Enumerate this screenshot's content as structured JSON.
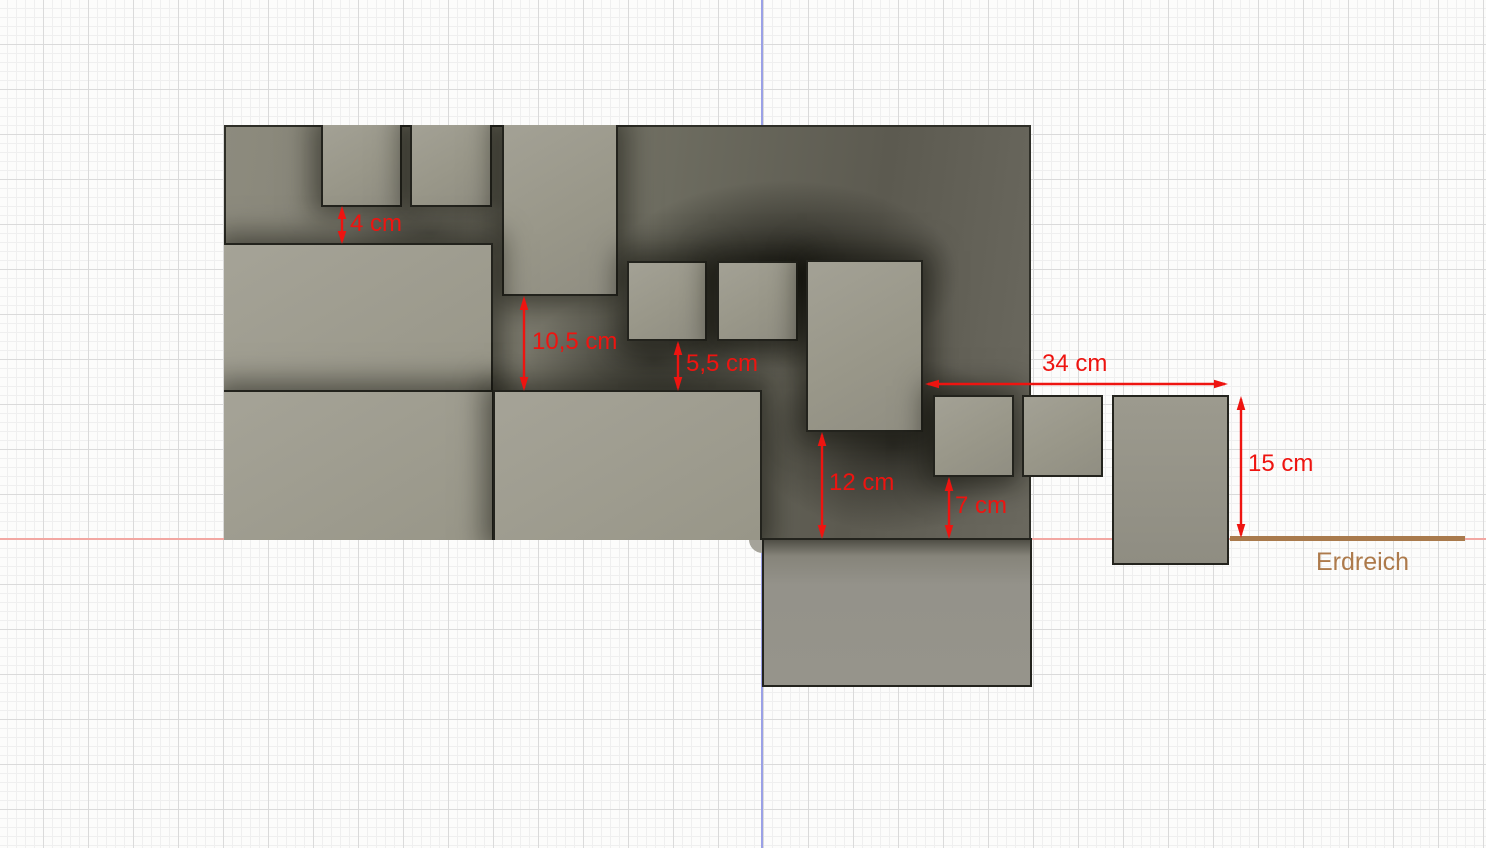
{
  "scene": {
    "dimensions": [
      {
        "id": "gap-top",
        "label": "4 cm"
      },
      {
        "id": "gap-mid-left",
        "label": "10,5 cm"
      },
      {
        "id": "gap-mid-center",
        "label": "5,5 cm"
      },
      {
        "id": "gap-low-center",
        "label": "12 cm"
      },
      {
        "id": "gap-low-right",
        "label": "7 cm"
      },
      {
        "id": "span-right",
        "label": "34 cm"
      },
      {
        "id": "depth-right",
        "label": "15 cm"
      }
    ],
    "ground_label": "Erdreich",
    "colors": {
      "dimension_red": "#ee1410",
      "ground_brown": "#a97a4c",
      "axis_horizontal_pink": "#f2a7a2",
      "axis_vertical_blue": "#9aa0e6",
      "block_gray": "#9b998c",
      "cavity_dark": "#3c3b33"
    }
  }
}
